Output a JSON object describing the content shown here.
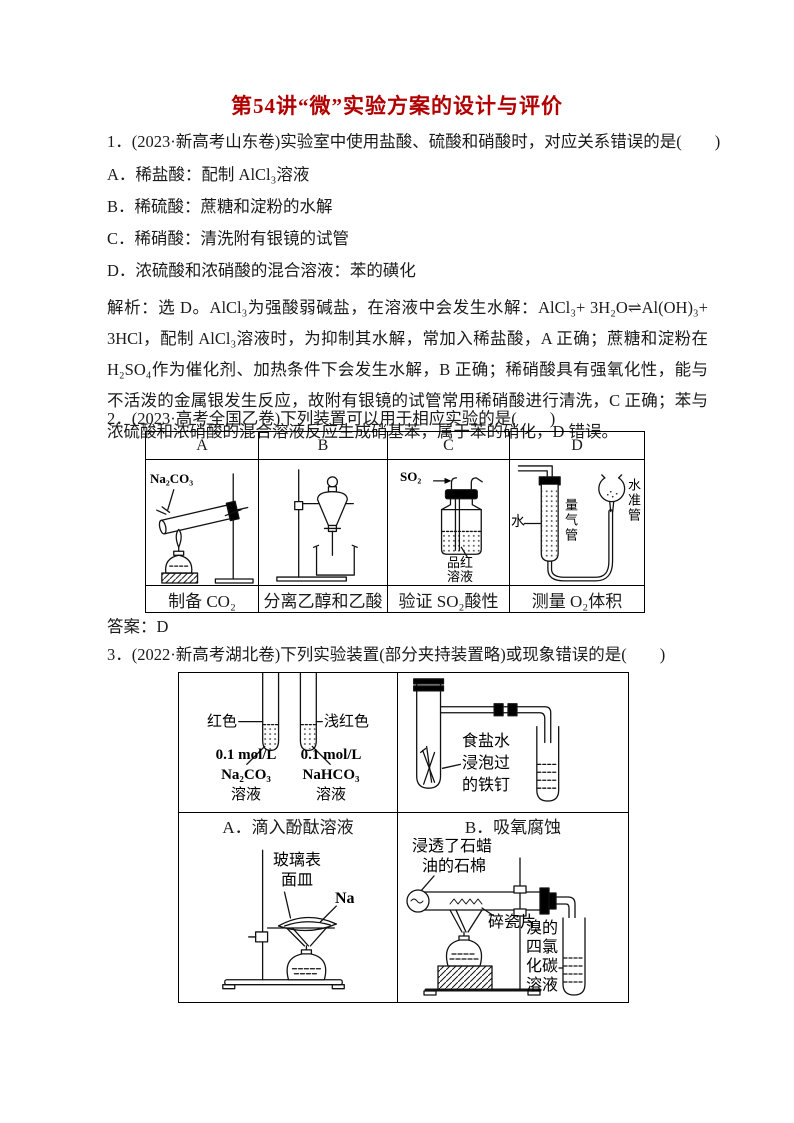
{
  "title": "第54讲“微”实验方案的设计与评价",
  "title_color": "#b00000",
  "q1": {
    "stem": "1．(2023·新高考山东卷)实验室中使用盐酸、硫酸和硝酸时，对应关系错误的是(　　)",
    "options": [
      "A．稀盐酸：配制 AlCl₃溶液",
      "B．稀硫酸：蔗糖和淀粉的水解",
      "C．稀硝酸：清洗附有银镜的试管",
      "D．浓硫酸和浓硝酸的混合溶液：苯的磺化"
    ],
    "analysis": "解析：选 D。AlCl₃为强酸弱碱盐，在溶液中会发生水解：AlCl₃+ 3H₂O⇌Al(OH)₃+ 3HCl，配制 AlCl₃溶液时，为抑制其水解，常加入稀盐酸，A 正确；蔗糖和淀粉在 H₂SO₄作为催化剂、加热条件下会发生水解，B 正确；稀硝酸具有强氧化性，能与不活泼的金属银发生反应，故附有银镜的试管常用稀硝酸进行清洗，C 正确；苯与浓硫酸和浓硝酸的混合溶液反应生成硝基苯，属于苯的硝化，D 错误。"
  },
  "q2": {
    "stem": "2．(2023·高考全国乙卷)下列装置可以用于相应实验的是(　　)",
    "columns": [
      "A",
      "B",
      "C",
      "D"
    ],
    "captions": [
      "制备 CO₂",
      "分离乙醇和乙酸",
      "验证 SO₂酸性",
      "测量 O₂体积"
    ],
    "labels": {
      "a_reagent": "Na₂CO₃",
      "c_gas": "SO₂",
      "c_solution_line1": "品红",
      "c_solution_line2": "溶液",
      "d_water": "水",
      "d_gas_tube": "量气管",
      "d_level_tube": "水准管"
    },
    "answer": "答案：D"
  },
  "q3": {
    "stem": "3．(2022·新高考湖北卷)下列实验装置(部分夹持装置略)或现象错误的是(　　)",
    "captions": [
      "A．滴入酚酞溶液",
      "B．吸氧腐蚀"
    ],
    "labels": {
      "a_left_color": "红色",
      "a_right_color": "浅红色",
      "a_left_conc": "0.1 mol/L",
      "a_left_formula": "Na₂CO₃",
      "a_left_solution": "溶液",
      "a_right_conc": "0.1 mol/L",
      "a_right_formula": "NaHCO₃",
      "a_right_solution": "溶液",
      "b_nail": [
        "食盐水",
        "浸泡过",
        "的铁钉"
      ],
      "c_watch_glass": [
        "玻璃表",
        "面皿"
      ],
      "c_sodium": "Na",
      "d_paraffin": [
        "浸透了石蜡",
        "油的石棉"
      ],
      "d_porcelain": "碎瓷片",
      "d_bromine": [
        "溴的",
        "四氯",
        "化碳",
        "溶液"
      ]
    }
  }
}
